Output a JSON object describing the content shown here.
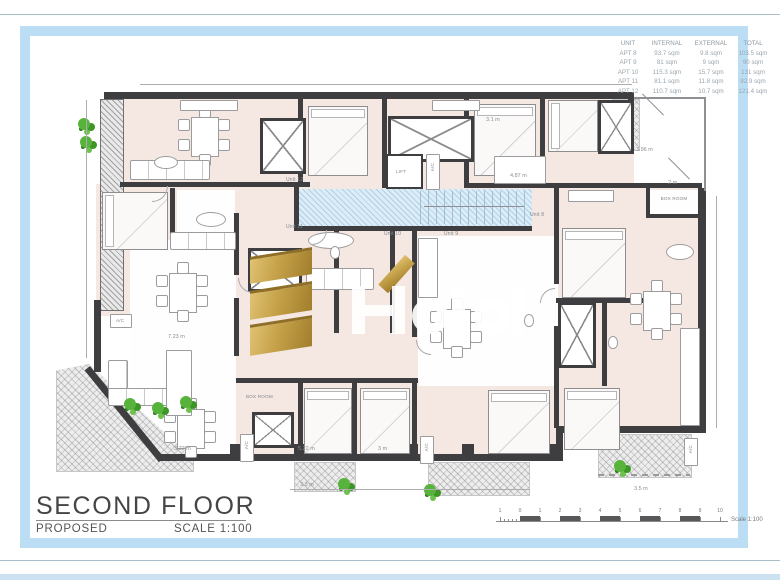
{
  "title_block": {
    "title": "SECOND FLOOR",
    "status": "PROPOSED",
    "scale": "SCALE 1:100"
  },
  "area_table": {
    "headers": {
      "unit": "UNIT",
      "internal": "INTERNAL",
      "external": "EXTERNAL",
      "total": "TOTAL"
    },
    "rows": [
      {
        "unit": "APT 8",
        "internal": "93.7 sqm",
        "external": "9.8 sqm",
        "total": "103.5 sqm"
      },
      {
        "unit": "APT 9",
        "internal": "81 sqm",
        "external": "9 sqm",
        "total": "90 sqm"
      },
      {
        "unit": "APT 10",
        "internal": "115.3 sqm",
        "external": "15.7 sqm",
        "total": "131 sqm"
      },
      {
        "unit": "APT 11",
        "internal": "81.1 sqm",
        "external": "11.8 sqm",
        "total": "92.9 sqm"
      },
      {
        "unit": "APT 12",
        "internal": "110.7 sqm",
        "external": "10.7 sqm",
        "total": "121.4 sqm"
      }
    ]
  },
  "plan": {
    "units": {
      "u12": "Unit 12",
      "u11": "Unit 11",
      "u10": "Unit 10",
      "u9": "Unit 9",
      "u8": "Unit 8"
    },
    "rooms": {
      "lift": "LIFT",
      "box_room": "BOX ROOM",
      "ac": "A/C"
    },
    "dimensions": {
      "d1": "3.22 m",
      "d2": "5.22 m",
      "d3": "3 m",
      "d4": "3.3 m",
      "d5": "3.5 m",
      "d6": "3.1 m",
      "d7": "4.87 m",
      "d8": "3.96 m",
      "d9": "2 m",
      "d10": "7.23 m"
    }
  },
  "scale_bar": {
    "labels": [
      "1",
      "0",
      "1",
      "2",
      "3",
      "4",
      "5",
      "6",
      "7",
      "8",
      "9",
      "10"
    ],
    "caption": "Scale 1:100"
  },
  "colors": {
    "frame_blue": "#bcdef5",
    "wall": "#3e3e40",
    "room_pink": "#f5e8e3",
    "stair_blue": "#dcedf7",
    "gold": "#c5a149",
    "plant_green": "#58b33c"
  }
}
